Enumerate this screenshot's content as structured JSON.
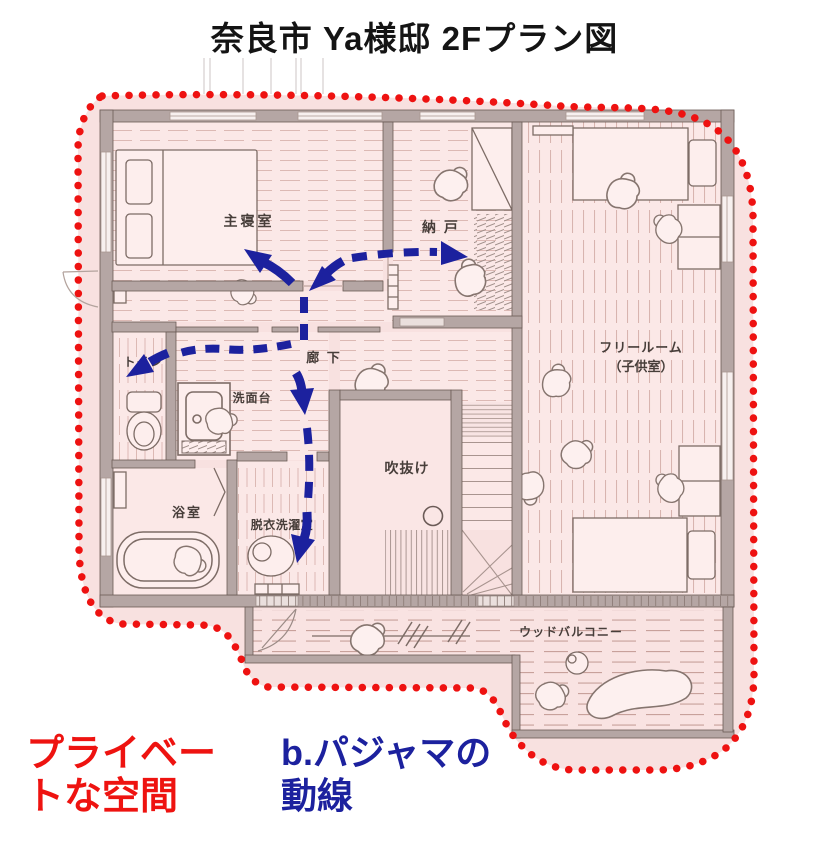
{
  "title": "奈良市  Ya様邸  2Fプラン図",
  "rooms": {
    "master_bedroom": "主寝室",
    "storage": "納 戸",
    "hallway": "廊 下",
    "toilet": "トイレ",
    "washstand": "洗面台",
    "bathroom": "浴室",
    "laundry": "脱衣洗濯室",
    "void": "吹抜け",
    "free_room_line1": "フリールーム",
    "free_room_line2": "（子供室）",
    "wood_balcony": "ウッドバルコニー"
  },
  "captions": {
    "private_space_line1": "プライベー",
    "private_space_line2": "トな空間",
    "flow_line1": "b.パジャマの",
    "flow_line2": "動線"
  },
  "colors": {
    "private_boundary_red": "#ee1211",
    "private_caption_red": "#ee1310",
    "flow_arrow_blue": "#1c219e",
    "plan_pink_fill": "#f8e1e0",
    "wall_gray": "#b5a6a4"
  }
}
